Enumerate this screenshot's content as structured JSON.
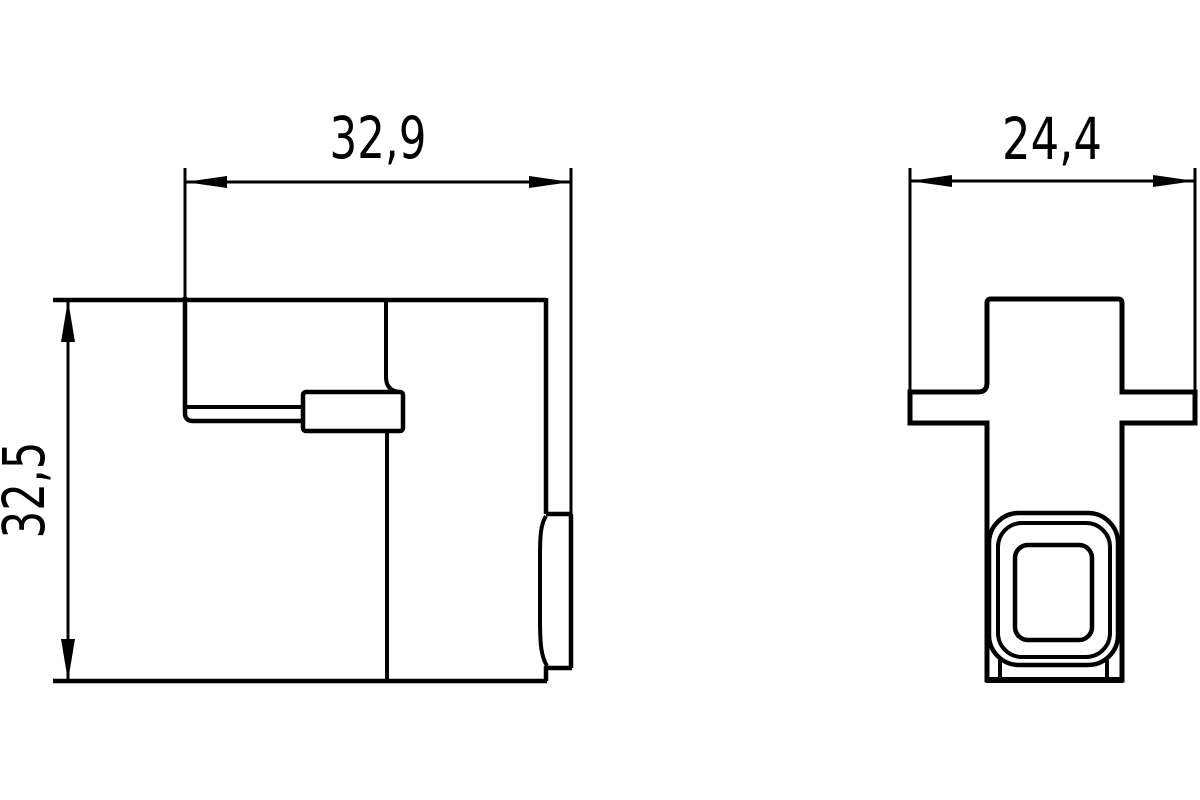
{
  "drawing": {
    "background_color": "#ffffff",
    "line_color": "#000000",
    "text_color": "#000000",
    "dimensions": {
      "side_view_width": "32,9",
      "side_view_height": "32,5",
      "front_view_width": "24,4"
    }
  }
}
